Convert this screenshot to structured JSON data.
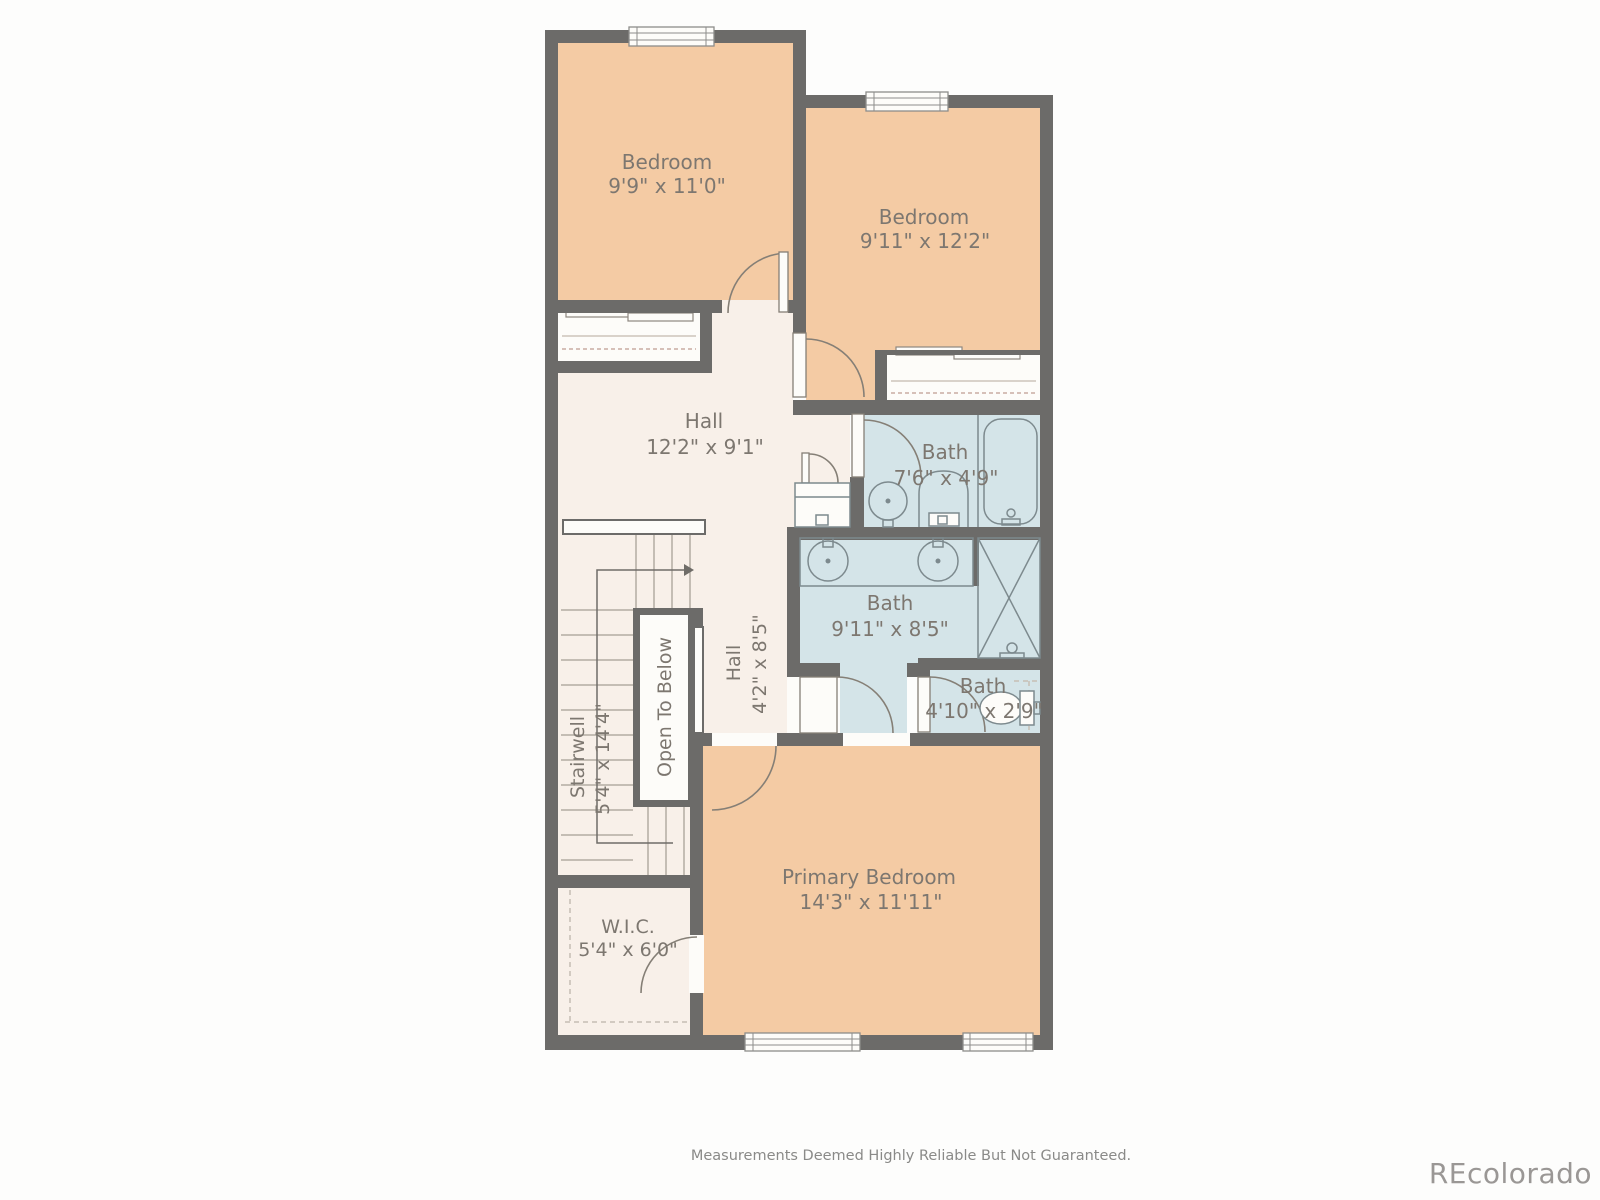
{
  "colors": {
    "paper_bg": "#fcfcfb",
    "paper": "#fdfcf9",
    "wall": "#6c6b69",
    "room_fill": "#f4cba4",
    "hall_fill": "#f8f0e9",
    "bath_fill": "#d4e4e8",
    "fixture": "#7d8a8e",
    "door": "#857f76",
    "tread": "#b2aca3",
    "dash": "#c6beb4",
    "winline": "#8d8d8a",
    "label": "#7d7770"
  },
  "rooms": {
    "bedroom_1": {
      "name": "Bedroom",
      "dims": "9'9\" x 11'0\""
    },
    "bedroom_2": {
      "name": "Bedroom",
      "dims": "9'11\" x 12'2\""
    },
    "hall_upper": {
      "name": "Hall",
      "dims": "12'2\" x 9'1\""
    },
    "bath_1": {
      "name": "Bath",
      "dims": "7'6\" x 4'9\""
    },
    "bath_2": {
      "name": "Bath",
      "dims": "9'11\" x 8'5\""
    },
    "bath_3": {
      "name": "Bath",
      "dims": "4'10\" x 2'9\""
    },
    "stairwell": {
      "name": "Stairwell",
      "dims": "5'4\" x 14'4\""
    },
    "open_to_below": {
      "name": "Open To Below"
    },
    "hall_lower": {
      "name": "Hall",
      "dims": "4'2\" x 8'5\""
    },
    "primary_bedroom": {
      "name": "Primary Bedroom",
      "dims": "14'3\" x 11'11\""
    },
    "wic": {
      "name": "W.I.C.",
      "dims": "5'4\" x 6'0\""
    }
  },
  "footer": {
    "disclaimer": "Measurements Deemed Highly Reliable But Not Guaranteed.",
    "brand": "REcolorado"
  }
}
